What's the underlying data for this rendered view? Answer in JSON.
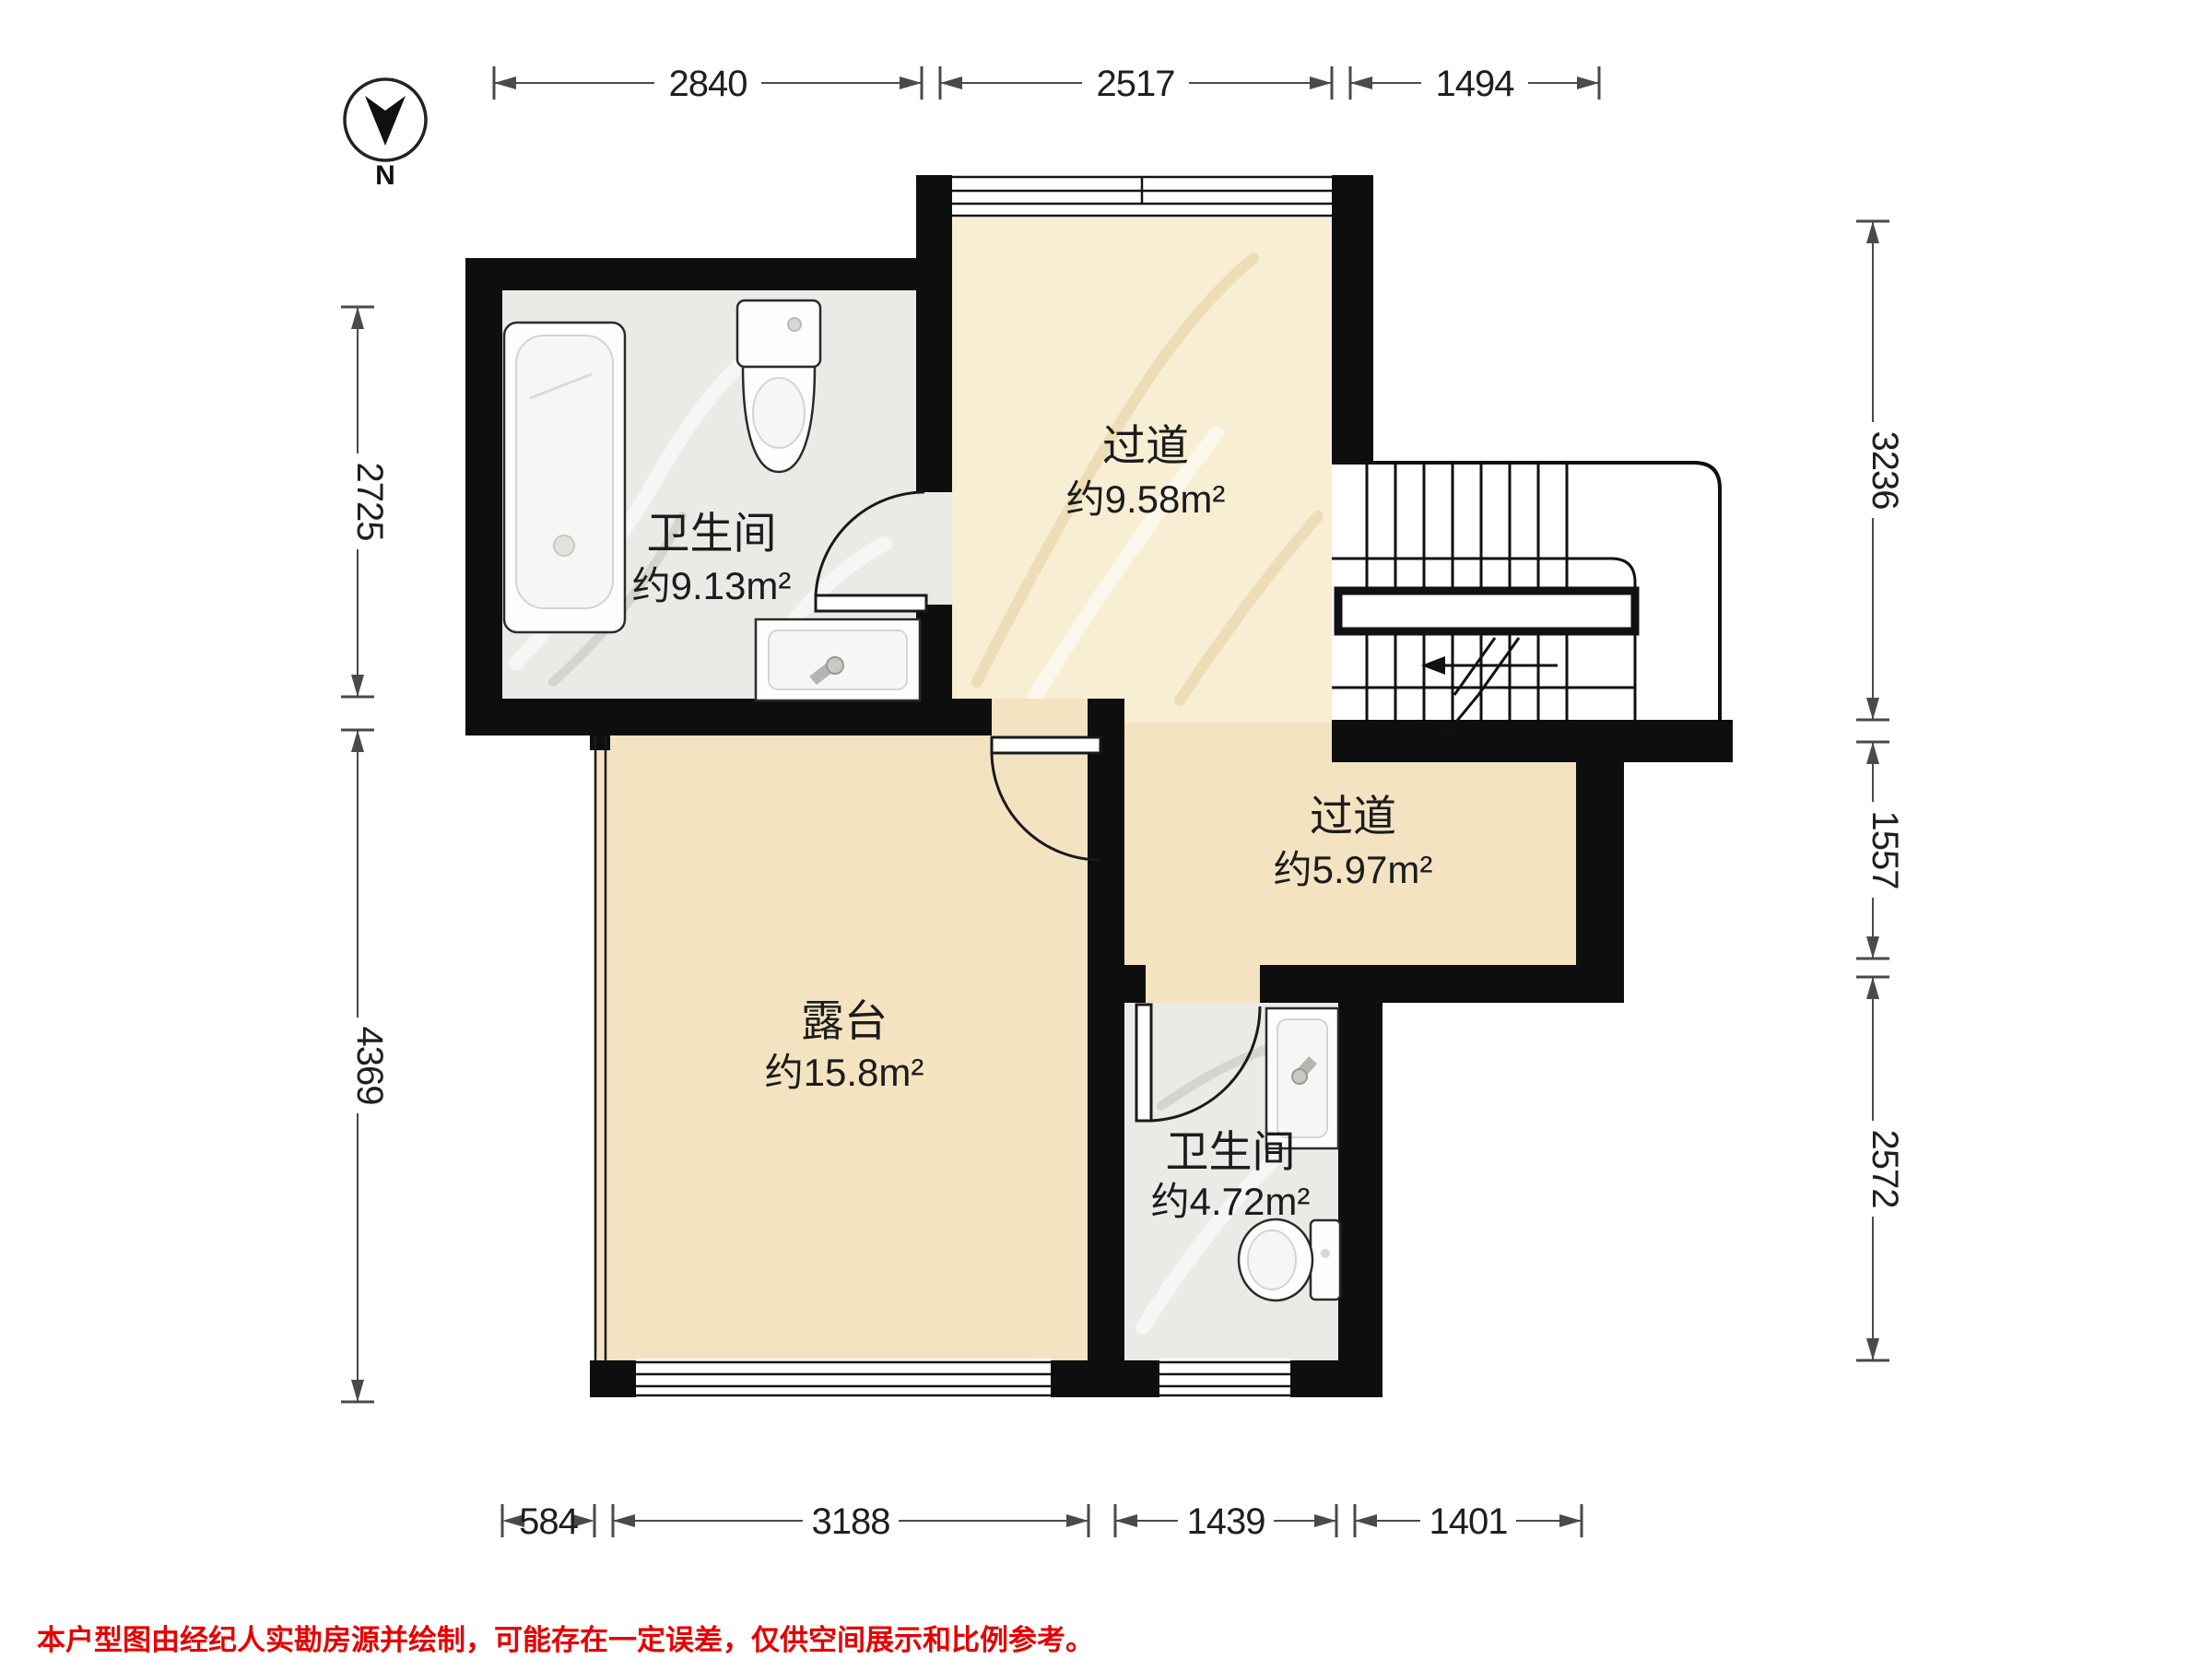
{
  "compass": {
    "label": "N"
  },
  "rooms": [
    {
      "name": "卫生间",
      "area": "约9.13m²"
    },
    {
      "name": "过道",
      "area": "约9.58m²"
    },
    {
      "name": "过道",
      "area": "约5.97m²"
    },
    {
      "name": "露台",
      "area": "约15.8m²"
    },
    {
      "name": "卫生间",
      "area": "约4.72m²"
    }
  ],
  "dimensions": {
    "top": [
      "2840",
      "2517",
      "1494"
    ],
    "left": [
      "2725",
      "4369"
    ],
    "right": [
      "3236",
      "1557",
      "2572"
    ],
    "bottom": [
      "584",
      "3188",
      "1439",
      "1401"
    ]
  },
  "disclaimer": "本户型图由经纪人实勘房源并绘制，可能存在一定误差，仅供空间展示和比例参考。",
  "colors": {
    "wall": "#0e0e0e",
    "floorBeige": "#f3e3c1",
    "marbleCream": "#f7eed3",
    "marbleGray": "#eceae7",
    "dimLine": "#4a4a4a",
    "dimText": "#1f1f1f",
    "labelText": "#1c1c1c",
    "disclaimerRed": "#e60000",
    "fixtureStroke": "#2b2b2b"
  }
}
